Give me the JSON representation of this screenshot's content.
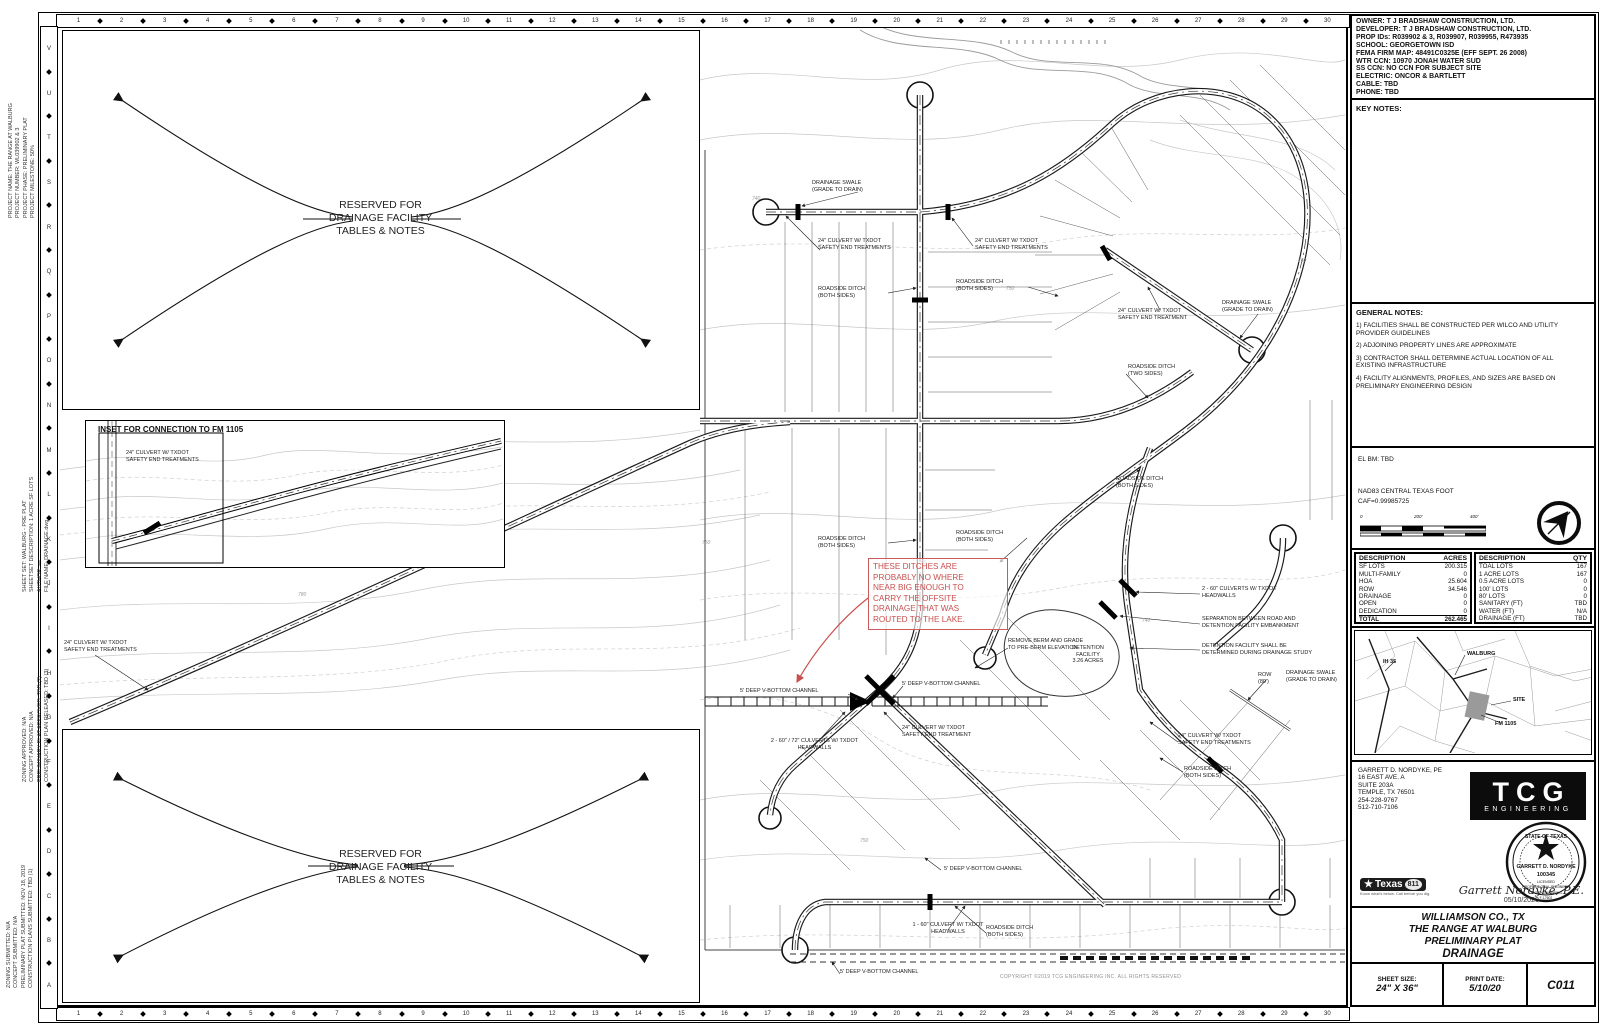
{
  "sheet": {
    "grid_numbers": [
      "1",
      "2",
      "3",
      "4",
      "5",
      "6",
      "7",
      "8",
      "9",
      "10",
      "11",
      "12",
      "13",
      "14",
      "15",
      "16",
      "17",
      "18",
      "19",
      "20",
      "21",
      "22",
      "23",
      "24",
      "25",
      "26",
      "27",
      "28",
      "29",
      "30"
    ],
    "grid_letters": [
      "V",
      "U",
      "T",
      "S",
      "R",
      "Q",
      "P",
      "O",
      "N",
      "M",
      "L",
      "K",
      "J",
      "I",
      "H",
      "G",
      "F",
      "E",
      "D",
      "C",
      "B",
      "A"
    ],
    "margin_notes": {
      "project": [
        "PROJECT NAME:  THE RANGE AT WALBURG",
        "PROJECT NUMBER:  WL039902 & 3",
        "PROJECT PHASE:  PRELIMINARY PLAT",
        "PROJECT MILESTONE:  50%"
      ],
      "sheetset": [
        "SHEET SET:  WALBURG - PRE PLAT",
        "SHEETSET DESCRIPTION:  1 ACRE SF LOTS",
        "AUTHOR:  —",
        "FILE NAME:  DRAINAGE.dwg"
      ],
      "approvals": [
        "ZONING APPROVED:  N/A",
        "CONCEPT APPROVED:  N/A",
        "PRELIMINARY PLAT APPROVED:  TBD (2)",
        "CONSTRUCTION PLAN RELEASED:  TBD (3)"
      ],
      "submittals": [
        "ZONING SUBMITTED:  N/A",
        "CONCEPT SUBMITTED:  N/A",
        "PRELIMINARY PLAT SUBMITTED:  NOV 18, 2019",
        "CONSTRUCTION PLANS SUBMITTED:  TBD (1)"
      ]
    }
  },
  "reserved_note": "RESERVED FOR\nDRAINAGE FACILITY\nTABLES & NOTES",
  "inset": {
    "title": "INSET FOR CONNECTION TO FM 1105"
  },
  "plan": {
    "red_note": "THESE DITCHES ARE\nPROBABLY NO WHERE\nNEAR BIG ENOUGH TO\nCARRY THE OFFSITE\nDRAINAGE THAT WAS\nROUTED TO THE LAKE.",
    "copyright": "COPYRIGHT ©2019 TCG ENGINEERING INC. ALL RIGHTS RESERVED",
    "labels": [
      {
        "text": "DRAINAGE SWALE\n(GRADE TO DRAIN)",
        "x": 812,
        "y": 180,
        "w": 70
      },
      {
        "text": "24\" CULVERT W/ TXDOT\nSAFETY END TREATMENTS",
        "x": 818,
        "y": 238,
        "w": 92
      },
      {
        "text": "24\" CULVERT W/ TXDOT\nSAFETY END TREATMENTS",
        "x": 975,
        "y": 238,
        "w": 92
      },
      {
        "text": "ROADSIDE DITCH\n(BOTH SIDES)",
        "x": 818,
        "y": 286,
        "w": 70
      },
      {
        "text": "ROADSIDE DITCH\n(BOTH SIDES)",
        "x": 956,
        "y": 279,
        "w": 70
      },
      {
        "text": "24\" CULVERT W/ TXDOT\nSAFETY END TREATMENT",
        "x": 1118,
        "y": 308,
        "w": 92
      },
      {
        "text": "DRAINAGE SWALE\n(GRADE TO DRAIN)",
        "x": 1222,
        "y": 300,
        "w": 72
      },
      {
        "text": "ROADSIDE DITCH\n(TWO SIDES)",
        "x": 1128,
        "y": 364,
        "w": 70
      },
      {
        "text": "ROADSIDE DITCH\n(BOTH SIDES)",
        "x": 1116,
        "y": 476,
        "w": 70
      },
      {
        "text": "ROADSIDE DITCH\n(BOTH SIDES)",
        "x": 818,
        "y": 536,
        "w": 70
      },
      {
        "text": "ROADSIDE DITCH\n(BOTH SIDES)",
        "x": 956,
        "y": 530,
        "w": 70
      },
      {
        "text": "2 - 60\" CULVERTS W/ TXDOT\nHEADWALLS",
        "x": 1202,
        "y": 586,
        "w": 110
      },
      {
        "text": "SEPARATION BETWEEN ROAD AND\nDETENTION FACILITY EMBANKMENT",
        "x": 1202,
        "y": 616,
        "w": 122
      },
      {
        "text": "DETENTION FACILITY SHALL BE\nDETERMINED DURING DRAINAGE STUDY",
        "x": 1202,
        "y": 643,
        "w": 128
      },
      {
        "text": "REMOVE BERM AND GRADE\nTO PRE-BERM ELEVATION",
        "x": 1008,
        "y": 638,
        "w": 96
      },
      {
        "text": "DETENTION\nFACILITY\n3.26 ACRES",
        "x": 1062,
        "y": 645,
        "w": 52,
        "ta": "center"
      },
      {
        "text": "ROW\n(80')",
        "x": 1258,
        "y": 672,
        "w": 24
      },
      {
        "text": "DRAINAGE SWALE\n(GRADE TO DRAIN)",
        "x": 1286,
        "y": 670,
        "w": 72
      },
      {
        "text": "24\" CULVERT W/ TXDOT\nSAFETY END TREATMENTS",
        "x": 1178,
        "y": 733,
        "w": 92
      },
      {
        "text": "ROADSIDE DITCH\n(BOTH SIDES)",
        "x": 1184,
        "y": 766,
        "w": 70
      },
      {
        "text": "5' DEEP V-BOTTOM CHANNEL",
        "x": 740,
        "y": 688,
        "w": 115
      },
      {
        "text": "5' DEEP V-BOTTOM CHANNEL",
        "x": 902,
        "y": 681,
        "w": 115
      },
      {
        "text": "2 - 60\" / 72\" CULVERTS W/ TXDOT\nHEADWALLS",
        "x": 752,
        "y": 738,
        "w": 125,
        "ta": "center"
      },
      {
        "text": "24\" CULVERT W/ TXDOT\nSAFETY END TREATMENT",
        "x": 902,
        "y": 725,
        "w": 92
      },
      {
        "text": "5' DEEP V-BOTTOM CHANNEL",
        "x": 944,
        "y": 866,
        "w": 115
      },
      {
        "text": "1 - 60\" CULVERT W/ TXDOT\nHEADWALLS",
        "x": 898,
        "y": 922,
        "w": 100,
        "ta": "center"
      },
      {
        "text": "ROADSIDE DITCH\n(BOTH SIDES)",
        "x": 986,
        "y": 925,
        "w": 70
      },
      {
        "text": "5' DEEP V-BOTTOM CHANNEL",
        "x": 840,
        "y": 969,
        "w": 115
      },
      {
        "text": "24\" CULVERT W/ TXDOT\nSAFETY END TREATMENTS",
        "x": 126,
        "y": 450,
        "w": 92
      },
      {
        "text": "24\" CULVERT W/ TXDOT\nSAFETY END TREATMENTS",
        "x": 64,
        "y": 640,
        "w": 92
      }
    ],
    "contour_labels": [
      {
        "text": "740",
        "x": 752,
        "y": 196
      },
      {
        "text": "750",
        "x": 1006,
        "y": 286
      },
      {
        "text": "760",
        "x": 1298,
        "y": 258
      },
      {
        "text": "750",
        "x": 702,
        "y": 540
      },
      {
        "text": "740",
        "x": 1142,
        "y": 618
      },
      {
        "text": "760",
        "x": 918,
        "y": 560
      },
      {
        "text": "780",
        "x": 298,
        "y": 592
      },
      {
        "text": "750",
        "x": 860,
        "y": 838
      }
    ]
  },
  "titleblock": {
    "owner_info": [
      "OWNER:  T J BRADSHAW CONSTRUCTION, LTD.",
      "DEVELOPER: T J BRADSHAW CONSTRUCTION, LTD.",
      "PROP IDs:  R039902 & 3, R039907, R039955, R473935",
      "SCHOOL:  GEORGETOWN ISD",
      "FEMA FIRM MAP: 48491C0325E (EFF SEPT. 26 2008)",
      "WTR CCN: 10970 JONAH WATER SUD",
      "SS CCN:  NO CCN FOR SUBJECT SITE",
      "ELECTRIC:  ONCOR & BARTLETT",
      "CABLE:  TBD",
      "PHONE:  TBD"
    ],
    "key_notes_title": "KEY NOTES:",
    "general_notes_title": "GENERAL NOTES:",
    "general_notes": [
      "1)  FACILITIES SHALL BE CONSTRUCTED PER WILCO AND UTILITY PROVIDER GUIDELINES",
      "2)  ADJOINING PROPERTY LINES ARE APPROXIMATE",
      "3)  CONTRACTOR SHALL DETERMINE ACTUAL LOCATION OF ALL EXISTING INFRASTRUCTURE",
      "4)  FACILITY ALIGNMENTS, PROFILES, AND SIZES ARE BASED ON PRELIMINARY ENGINEERING DESIGN"
    ],
    "datum": {
      "el_bm": "EL BM: TBD",
      "datum_line1": "NAD83 CENTRAL TEXAS FOOT",
      "datum_line2": "CAF=0.99985725",
      "scale_ticks": [
        "0",
        "200'",
        "400'"
      ]
    },
    "acres_table": {
      "headers": {
        "col1": "DESCRIPTION",
        "col2": "ACRES"
      },
      "rows": [
        {
          "label": "SF LOTS",
          "value": "200.315"
        },
        {
          "label": "MULTI-FAMILY",
          "value": "0"
        },
        {
          "label": "HOA",
          "value": "25.604"
        },
        {
          "label": "ROW",
          "value": "34.546"
        },
        {
          "label": "DRAINAGE",
          "value": "0"
        },
        {
          "label": "OPEN",
          "value": "0"
        },
        {
          "label": "DEDICATION",
          "value": "0"
        },
        {
          "label": "TOTAL",
          "value": "262.465",
          "cls": "bold"
        }
      ]
    },
    "qty_table": {
      "headers": {
        "col1": "DESCRIPTION",
        "col2": "QTY"
      },
      "rows": [
        {
          "label": "TOAL LOTS",
          "value": "167"
        },
        {
          "label": "1 ACRE LOTS",
          "value": "167"
        },
        {
          "label": "0.5 ACRE LOTS",
          "value": "0"
        },
        {
          "label": "100' LOTS",
          "value": "0"
        },
        {
          "label": "80' LOTS",
          "value": "0"
        },
        {
          "label": "SANITARY (FT)",
          "value": "TBD"
        },
        {
          "label": "WATER (FT)",
          "value": "N/A"
        },
        {
          "label": "DRAINAGE (FT)",
          "value": "TBD"
        }
      ]
    },
    "vicinity_labels": [
      {
        "text": "IH 35",
        "x": 28,
        "y": 28
      },
      {
        "text": "WALBURG",
        "x": 112,
        "y": 20
      },
      {
        "text": "SITE",
        "x": 158,
        "y": 66
      },
      {
        "text": "FM 1105",
        "x": 140,
        "y": 90
      }
    ],
    "engineer": {
      "lines": [
        "GARRETT D. NORDYKE, PE",
        "16 EAST AVE. A",
        "SUITE 203A",
        "TEMPLE, TX 76501",
        "254-228-9767",
        "512-710-7106"
      ],
      "firm": "TCG",
      "firm_sub": "ENGINEERING"
    },
    "seal": {
      "top": "STATE OF TEXAS",
      "name": "GARRETT D. NORDYKE",
      "number": "100345",
      "line1": "LICENSED",
      "line2": "PROFESSIONAL ENGINEER",
      "firm": "TCG ENGINEERING",
      "reg": "F-17602"
    },
    "utility_logo": {
      "star": "★",
      "text": "Texas",
      "num": "811",
      "tag1": "Know what's below.",
      "tag2": "Call before you dig."
    },
    "signature": {
      "name": "Garrett Nordyke, P.E.",
      "date": "05/10/2020"
    },
    "project_title": [
      "WILLIAMSON CO., TX",
      "THE RANGE AT WALBURG",
      "PRELIMINARY PLAT",
      "DRAINAGE"
    ],
    "footer": {
      "sheet_size_label": "SHEET SIZE:",
      "sheet_size": "24\" X 36\"",
      "print_date_label": "PRINT DATE:",
      "print_date": "5/10/20",
      "sheet_number": "C011"
    }
  }
}
